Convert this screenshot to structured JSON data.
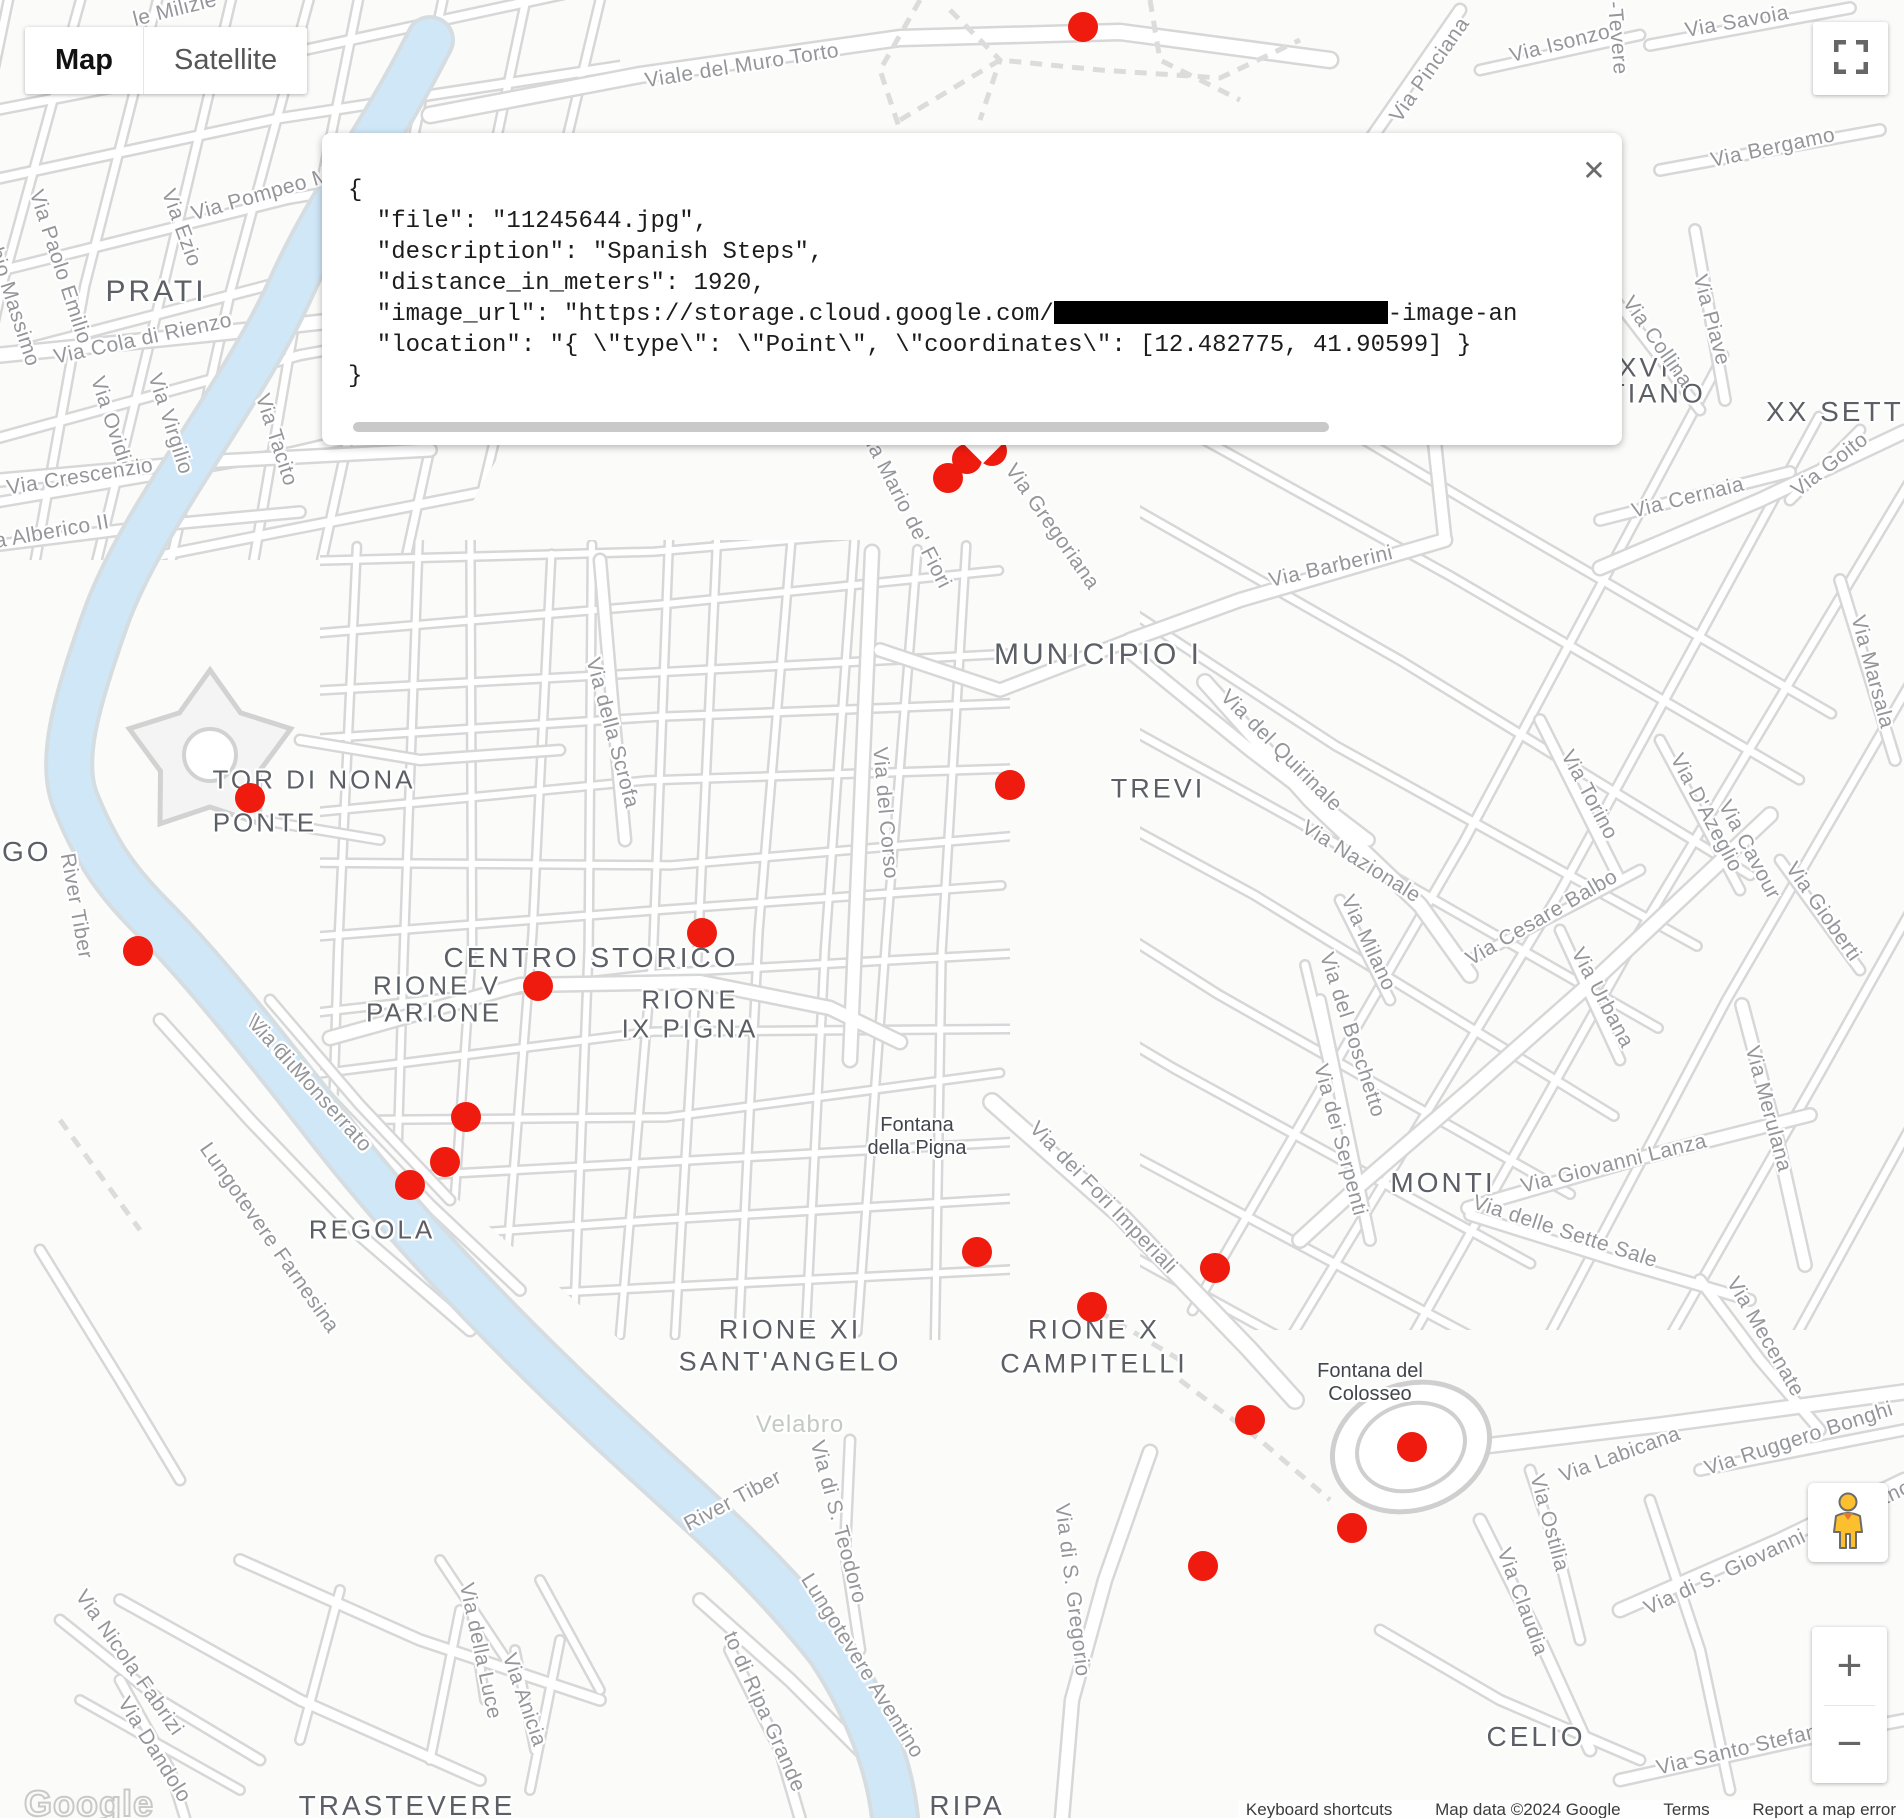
{
  "theme": {
    "marker_color": "#ee1b0e",
    "road_casing": "#d7d7d7",
    "road_fill": "#ffffff",
    "water": "#cfe7f7",
    "background": "#fbfbfa"
  },
  "map_controls": {
    "map_label": "Map",
    "satellite_label": "Satellite"
  },
  "zoom_control": {
    "zoom_in": "+",
    "zoom_out": "−"
  },
  "info_window": {
    "close_icon": "✕",
    "line_open": "{",
    "line_file": "  \"file\": \"11245644.jpg\",",
    "line_description": "  \"description\": \"Spanish Steps\",",
    "line_distance": "  \"distance_in_meters\": 1920,",
    "url_line_prefix": "  \"image_url\": \"https://storage.cloud.google.com/",
    "url_line_suffix": "-image-an",
    "line_location": "  \"location\": \"{ \\\"type\\\": \\\"Point\\\", \\\"coordinates\\\": [12.482775, 41.90599] }",
    "line_close": "}"
  },
  "google_logo": "Google",
  "attribution": [
    "Keyboard shortcuts",
    "Map data ©2024 Google",
    "Terms",
    "Report a map error"
  ],
  "markers": [
    {
      "x": 1083,
      "y": 27
    },
    {
      "x": 967,
      "y": 459
    },
    {
      "x": 992,
      "y": 451
    },
    {
      "x": 948,
      "y": 478
    },
    {
      "x": 250,
      "y": 798
    },
    {
      "x": 138,
      "y": 951
    },
    {
      "x": 1010,
      "y": 785
    },
    {
      "x": 702,
      "y": 933
    },
    {
      "x": 538,
      "y": 986
    },
    {
      "x": 466,
      "y": 1117
    },
    {
      "x": 445,
      "y": 1162
    },
    {
      "x": 410,
      "y": 1185
    },
    {
      "x": 977,
      "y": 1252
    },
    {
      "x": 1215,
      "y": 1268
    },
    {
      "x": 1092,
      "y": 1307
    },
    {
      "x": 1250,
      "y": 1420
    },
    {
      "x": 1412,
      "y": 1447
    },
    {
      "x": 1352,
      "y": 1528
    },
    {
      "x": 1203,
      "y": 1566
    }
  ],
  "region_labels": [
    {
      "t": "PRATI",
      "x": 156,
      "y": 292,
      "s": 30
    },
    {
      "t": "GO",
      "x": 2,
      "y": 852,
      "s": 28,
      "align": "left"
    },
    {
      "t": "TOR DI NONA",
      "x": 314,
      "y": 780,
      "s": 26
    },
    {
      "t": "PONTE",
      "x": 265,
      "y": 823,
      "s": 26
    },
    {
      "t": "CENTRO STORICO",
      "x": 591,
      "y": 958,
      "s": 28
    },
    {
      "t": "RIONE V",
      "x": 437,
      "y": 986,
      "s": 26
    },
    {
      "t": "PARIONE",
      "x": 434,
      "y": 1013,
      "s": 26
    },
    {
      "t": "RIONE",
      "x": 690,
      "y": 1000,
      "s": 26
    },
    {
      "t": "IX PIGNA",
      "x": 690,
      "y": 1029,
      "s": 26
    },
    {
      "t": "REGOLA",
      "x": 372,
      "y": 1230,
      "s": 26
    },
    {
      "t": "MUNICIPIO I",
      "x": 1098,
      "y": 655,
      "s": 30
    },
    {
      "t": "TREVI",
      "x": 1158,
      "y": 789,
      "s": 27
    },
    {
      "t": "MONTI",
      "x": 1443,
      "y": 1183,
      "s": 28
    },
    {
      "t": "RIONE XI",
      "x": 790,
      "y": 1330,
      "s": 27
    },
    {
      "t": "SANT'ANGELO",
      "x": 790,
      "y": 1362,
      "s": 27
    },
    {
      "t": "RIONE X",
      "x": 1094,
      "y": 1330,
      "s": 27
    },
    {
      "t": "CAMPITELLI",
      "x": 1094,
      "y": 1364,
      "s": 27
    },
    {
      "t": "CELIO",
      "x": 1536,
      "y": 1737,
      "s": 28
    },
    {
      "t": "TRASTEVERE",
      "x": 407,
      "y": 1806,
      "s": 28
    },
    {
      "t": "RIPA",
      "x": 967,
      "y": 1806,
      "s": 28
    },
    {
      "t": "XVII",
      "x": 1650,
      "y": 368,
      "s": 27
    },
    {
      "t": "TIANO",
      "x": 1657,
      "y": 394,
      "s": 27
    },
    {
      "t": "XX SETTEM",
      "x": 1766,
      "y": 412,
      "s": 28,
      "align": "left"
    }
  ],
  "street_labels": [
    {
      "t": "le Milizie",
      "x": 175,
      "y": 10,
      "r": -14
    },
    {
      "t": "Viale del Muro Torto",
      "x": 742,
      "y": 66,
      "r": -9
    },
    {
      "t": "Via Pinciana",
      "x": 1430,
      "y": 70,
      "r": -55
    },
    {
      "t": "Via Isonzo",
      "x": 1560,
      "y": 44,
      "r": -14
    },
    {
      "t": "-Tevere",
      "x": 1617,
      "y": 38,
      "r": 85
    },
    {
      "t": "Via Savoia",
      "x": 1737,
      "y": 22,
      "r": -10
    },
    {
      "t": "Via Bergamo",
      "x": 1773,
      "y": 148,
      "r": -12
    },
    {
      "t": "Via Collina",
      "x": 1657,
      "y": 342,
      "r": 55
    },
    {
      "t": "Via Piave",
      "x": 1711,
      "y": 320,
      "r": 75
    },
    {
      "t": "Via Goito",
      "x": 1830,
      "y": 465,
      "r": -38
    },
    {
      "t": "Via Cernaia",
      "x": 1688,
      "y": 498,
      "r": -14
    },
    {
      "t": "Via Marsala",
      "x": 1872,
      "y": 672,
      "r": 75
    },
    {
      "t": "Via Pompeo M",
      "x": 261,
      "y": 195,
      "r": -16
    },
    {
      "t": "Via Ezio",
      "x": 181,
      "y": 228,
      "r": 70
    },
    {
      "t": "Fabio Massimo",
      "x": 10,
      "y": 295,
      "r": 72
    },
    {
      "t": "Via Paolo Emilio",
      "x": 60,
      "y": 267,
      "r": 72
    },
    {
      "t": "Via Cola di Rienzo",
      "x": 143,
      "y": 339,
      "r": -12
    },
    {
      "t": "Via Ovidio",
      "x": 112,
      "y": 425,
      "r": 72
    },
    {
      "t": "Via Virgilio",
      "x": 170,
      "y": 424,
      "r": 72
    },
    {
      "t": "Via Tacito",
      "x": 276,
      "y": 440,
      "r": 72
    },
    {
      "t": "Via Crescenzio",
      "x": 80,
      "y": 477,
      "r": -9
    },
    {
      "t": "a Alberico II",
      "x": 52,
      "y": 532,
      "r": -10
    },
    {
      "t": "River Tiber",
      "x": 76,
      "y": 906,
      "r": 80
    },
    {
      "t": "Lungotevere Farnesina",
      "x": 269,
      "y": 1238,
      "r": 55
    },
    {
      "t": "Via Giulia",
      "x": 281,
      "y": 1053,
      "r": 48
    },
    {
      "t": "Via di Monserrato",
      "x": 310,
      "y": 1085,
      "r": 48
    },
    {
      "t": "Via della Scrofa",
      "x": 612,
      "y": 733,
      "r": 75
    },
    {
      "t": "Via del Corso",
      "x": 885,
      "y": 813,
      "r": 85
    },
    {
      "t": "Via Mario de' Fiori",
      "x": 905,
      "y": 508,
      "r": 63
    },
    {
      "t": "Via Gregoriana",
      "x": 1052,
      "y": 527,
      "r": 55
    },
    {
      "t": "Via Barberini",
      "x": 1331,
      "y": 567,
      "r": -13
    },
    {
      "t": "Via del Quirinale",
      "x": 1281,
      "y": 751,
      "r": 45
    },
    {
      "t": "Via Nazionale",
      "x": 1361,
      "y": 862,
      "r": 32
    },
    {
      "t": "Via Milano",
      "x": 1368,
      "y": 943,
      "r": 65
    },
    {
      "t": "Via del Boschetto",
      "x": 1352,
      "y": 1035,
      "r": 72
    },
    {
      "t": "Via dei Serpenti",
      "x": 1340,
      "y": 1140,
      "r": 75
    },
    {
      "t": "Via Cesare Balbo",
      "x": 1542,
      "y": 918,
      "r": -30
    },
    {
      "t": "Via Torino",
      "x": 1589,
      "y": 795,
      "r": 62
    },
    {
      "t": "Via D'Azeglio",
      "x": 1706,
      "y": 813,
      "r": 62
    },
    {
      "t": "Via Cavour",
      "x": 1749,
      "y": 850,
      "r": 62
    },
    {
      "t": "Via Gioberti",
      "x": 1823,
      "y": 912,
      "r": 55
    },
    {
      "t": "Via Urbana",
      "x": 1602,
      "y": 998,
      "r": 62
    },
    {
      "t": "Via Giovanni Lanza",
      "x": 1614,
      "y": 1164,
      "r": -14
    },
    {
      "t": "Via delle Sette Sale",
      "x": 1565,
      "y": 1232,
      "r": 18
    },
    {
      "t": "Via Merulana",
      "x": 1768,
      "y": 1109,
      "r": 75
    },
    {
      "t": "Via Mecenate",
      "x": 1765,
      "y": 1337,
      "r": 60
    },
    {
      "t": "Via Ruggero Bonghi",
      "x": 1799,
      "y": 1439,
      "r": -18
    },
    {
      "t": "Via Labicana",
      "x": 1620,
      "y": 1455,
      "r": -20
    },
    {
      "t": "Via di S. Giovanni in Laterano",
      "x": 1778,
      "y": 1548,
      "r": -25
    },
    {
      "t": "Via Ostilia",
      "x": 1549,
      "y": 1523,
      "r": 75
    },
    {
      "t": "Via Claudia",
      "x": 1522,
      "y": 1602,
      "r": 70
    },
    {
      "t": "Via Santo Stefano Ro",
      "x": 1760,
      "y": 1745,
      "r": -13
    },
    {
      "t": "Via di S. Gregorio",
      "x": 1072,
      "y": 1590,
      "r": 83
    },
    {
      "t": "Via di S. Teodoro",
      "x": 838,
      "y": 1522,
      "r": 75
    },
    {
      "t": "Via dei Fori Imperiali",
      "x": 1103,
      "y": 1198,
      "r": 46
    },
    {
      "t": "River Tiber",
      "x": 733,
      "y": 1501,
      "r": -28
    },
    {
      "t": "Lungotevere Aventino",
      "x": 862,
      "y": 1666,
      "r": 58
    },
    {
      "t": "to di Ripa Grande",
      "x": 764,
      "y": 1712,
      "r": 66
    },
    {
      "t": "Via della Luce",
      "x": 480,
      "y": 1651,
      "r": 78
    },
    {
      "t": "Via Anicia",
      "x": 524,
      "y": 1700,
      "r": 71
    },
    {
      "t": "Via Nicola Fabrizi",
      "x": 129,
      "y": 1663,
      "r": 55
    },
    {
      "t": "Via Dandolo",
      "x": 154,
      "y": 1750,
      "r": 58
    }
  ],
  "poi_labels": [
    {
      "lines": [
        "Fontana",
        "della Pigna"
      ],
      "x": 917,
      "y": 1114
    },
    {
      "lines": [
        "Fontana del",
        "Colosseo"
      ],
      "x": 1370,
      "y": 1360
    }
  ],
  "park_labels": [
    {
      "t": "Velabro",
      "x": 800,
      "y": 1425
    }
  ]
}
